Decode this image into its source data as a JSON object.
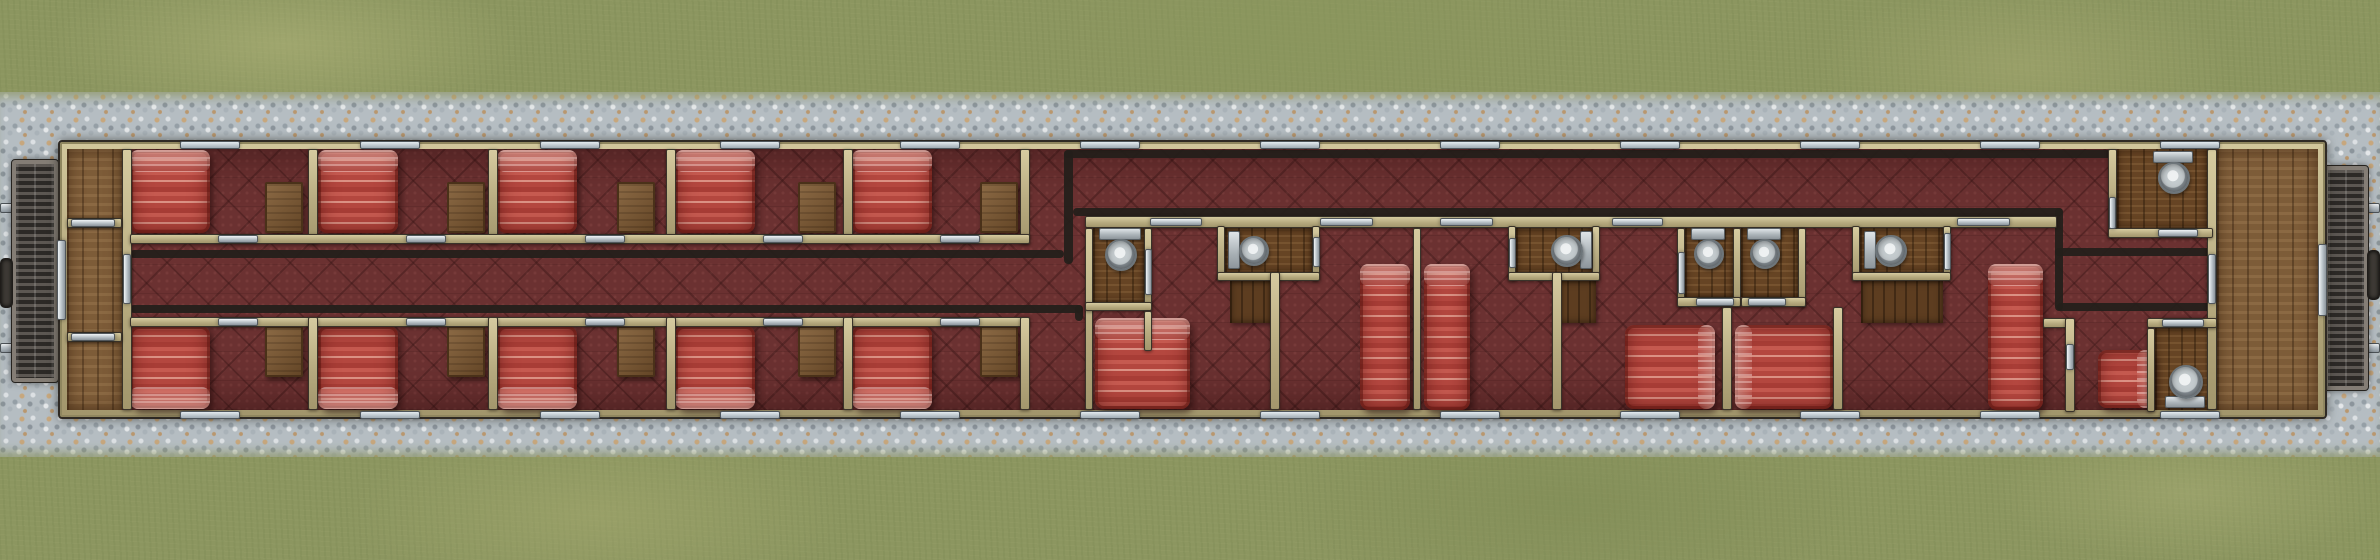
{
  "canvas": {
    "width": 2380,
    "height": 560
  },
  "palette": {
    "grass": "#8c9660",
    "gravel": "#b5bdc2",
    "car_wall_tan": "#b7ab80",
    "carpet_red": "#6b3131",
    "corridor_line": "#241f1b",
    "vestibule_wood": "#85623c",
    "washroom_wood": "#6e4a27",
    "bed_red": "#bb4b42",
    "metal_silver": "#b6bfc5",
    "table_wood": "#7b5731"
  },
  "environment": {
    "gravel_band": [
      0,
      92,
      2380,
      365
    ],
    "rails": [
      [
        0,
        203,
        60,
        10
      ],
      [
        0,
        343,
        60,
        10
      ],
      [
        2320,
        203,
        60,
        10
      ],
      [
        2320,
        343,
        60,
        10
      ]
    ],
    "gangways": [
      [
        12,
        160,
        46,
        222
      ],
      [
        2324,
        166,
        44,
        224
      ]
    ],
    "couplers": [
      [
        0,
        258,
        13,
        50
      ],
      [
        2367,
        250,
        13,
        50
      ]
    ]
  },
  "car": {
    "body": [
      58,
      140,
      2269,
      279
    ],
    "carpet": [
      67,
      149,
      2251,
      261
    ]
  },
  "floors": {
    "vestibules": [
      [
        67,
        149,
        55,
        261
      ],
      [
        2217,
        149,
        101,
        261
      ]
    ],
    "washrooms": [
      [
        1093,
        228,
        51,
        74
      ],
      [
        1225,
        228,
        87,
        44
      ],
      [
        1516,
        228,
        76,
        44
      ],
      [
        1685,
        228,
        48,
        69
      ],
      [
        1741,
        228,
        57,
        69
      ],
      [
        1860,
        228,
        83,
        44
      ],
      [
        2117,
        149,
        90,
        79
      ],
      [
        2155,
        328,
        62,
        82
      ]
    ],
    "wood_steps": [
      [
        1230,
        281,
        42,
        42
      ],
      [
        1556,
        281,
        40,
        42
      ],
      [
        1861,
        281,
        82,
        42
      ]
    ]
  },
  "corridor_lines": [
    [
      130,
      250,
      934,
      8
    ],
    [
      1064,
      150,
      9,
      114
    ],
    [
      1064,
      150,
      1149,
      8
    ],
    [
      1073,
      208,
      990,
      8
    ],
    [
      130,
      305,
      953,
      8
    ],
    [
      1075,
      305,
      8,
      16
    ],
    [
      2055,
      208,
      8,
      103
    ],
    [
      2055,
      248,
      158,
      8
    ],
    [
      2057,
      303,
      156,
      8
    ]
  ],
  "walls": [
    [
      122,
      149,
      10,
      261
    ],
    [
      67,
      218,
      55,
      10
    ],
    [
      67,
      332,
      55,
      10
    ],
    [
      2207,
      149,
      10,
      261
    ],
    [
      308,
      149,
      10,
      95
    ],
    [
      488,
      149,
      10,
      95
    ],
    [
      666,
      149,
      10,
      95
    ],
    [
      843,
      149,
      10,
      95
    ],
    [
      1020,
      149,
      10,
      95
    ],
    [
      130,
      234,
      900,
      10
    ],
    [
      130,
      317,
      900,
      10
    ],
    [
      308,
      317,
      10,
      93
    ],
    [
      488,
      317,
      10,
      93
    ],
    [
      666,
      317,
      10,
      93
    ],
    [
      843,
      317,
      10,
      93
    ],
    [
      1020,
      317,
      10,
      93
    ],
    [
      1085,
      216,
      972,
      12
    ],
    [
      1085,
      228,
      8,
      182
    ],
    [
      1144,
      228,
      8,
      83
    ],
    [
      1085,
      302,
      67,
      9
    ],
    [
      1144,
      311,
      8,
      40
    ],
    [
      1217,
      226,
      8,
      55
    ],
    [
      1312,
      226,
      8,
      55
    ],
    [
      1217,
      272,
      103,
      9
    ],
    [
      1270,
      272,
      10,
      138
    ],
    [
      1413,
      228,
      8,
      182
    ],
    [
      1508,
      226,
      8,
      55
    ],
    [
      1592,
      226,
      8,
      55
    ],
    [
      1508,
      272,
      92,
      9
    ],
    [
      1552,
      272,
      10,
      138
    ],
    [
      1677,
      228,
      8,
      79
    ],
    [
      1733,
      228,
      8,
      79
    ],
    [
      1798,
      228,
      8,
      79
    ],
    [
      1677,
      297,
      64,
      10
    ],
    [
      1741,
      297,
      65,
      10
    ],
    [
      1722,
      307,
      10,
      103
    ],
    [
      1833,
      307,
      10,
      103
    ],
    [
      1852,
      226,
      8,
      55
    ],
    [
      1943,
      226,
      8,
      55
    ],
    [
      1852,
      272,
      99,
      9
    ],
    [
      2043,
      318,
      32,
      10
    ],
    [
      2065,
      318,
      10,
      94
    ],
    [
      2147,
      318,
      70,
      10
    ],
    [
      2147,
      328,
      8,
      84
    ],
    [
      2108,
      149,
      9,
      89
    ],
    [
      2108,
      228,
      105,
      10
    ]
  ],
  "doors": {
    "horizontal": [
      [
        71,
        219,
        44,
        8
      ],
      [
        71,
        333,
        44,
        8
      ],
      [
        218,
        235,
        40,
        8
      ],
      [
        406,
        235,
        40,
        8
      ],
      [
        585,
        235,
        40,
        8
      ],
      [
        763,
        235,
        40,
        8
      ],
      [
        940,
        235,
        40,
        8
      ],
      [
        218,
        318,
        40,
        8
      ],
      [
        406,
        318,
        40,
        8
      ],
      [
        585,
        318,
        40,
        8
      ],
      [
        763,
        318,
        40,
        8
      ],
      [
        940,
        318,
        40,
        8
      ],
      [
        1150,
        218,
        52,
        8
      ],
      [
        1320,
        218,
        53,
        8
      ],
      [
        1440,
        218,
        53,
        8
      ],
      [
        1612,
        218,
        51,
        8
      ],
      [
        1957,
        218,
        53,
        8
      ],
      [
        1696,
        298,
        38,
        8
      ],
      [
        1748,
        298,
        38,
        8
      ],
      [
        2162,
        319,
        42,
        8
      ],
      [
        2158,
        229,
        40,
        8
      ]
    ],
    "vertical": [
      [
        123,
        254,
        8,
        50
      ],
      [
        2208,
        254,
        8,
        50
      ],
      [
        57,
        240,
        9,
        80
      ],
      [
        2318,
        244,
        9,
        72
      ],
      [
        1145,
        249,
        7,
        46
      ],
      [
        1313,
        237,
        7,
        30
      ],
      [
        1509,
        238,
        7,
        30
      ],
      [
        1678,
        252,
        7,
        42
      ],
      [
        1944,
        233,
        7,
        37
      ],
      [
        2066,
        344,
        8,
        26
      ],
      [
        2109,
        197,
        7,
        32
      ]
    ]
  },
  "windows": {
    "xs": [
      180,
      360,
      540,
      720,
      900,
      1080,
      1260,
      1440,
      1620,
      1800,
      1980,
      2160
    ],
    "top_y": 141,
    "bottom_y": 411,
    "w": 60,
    "h": 8
  },
  "furniture": {
    "beds": [
      {
        "r": [
          130,
          150,
          80,
          83
        ],
        "pillow": "top"
      },
      {
        "r": [
          318,
          150,
          80,
          83
        ],
        "pillow": "top"
      },
      {
        "r": [
          497,
          150,
          80,
          83
        ],
        "pillow": "top"
      },
      {
        "r": [
          675,
          150,
          80,
          83
        ],
        "pillow": "top"
      },
      {
        "r": [
          852,
          150,
          80,
          83
        ],
        "pillow": "top"
      },
      {
        "r": [
          130,
          326,
          80,
          83
        ],
        "pillow": "bottom"
      },
      {
        "r": [
          318,
          326,
          80,
          83
        ],
        "pillow": "bottom"
      },
      {
        "r": [
          497,
          326,
          80,
          83
        ],
        "pillow": "bottom"
      },
      {
        "r": [
          675,
          326,
          80,
          83
        ],
        "pillow": "bottom"
      },
      {
        "r": [
          852,
          326,
          80,
          83
        ],
        "pillow": "bottom"
      },
      {
        "r": [
          1095,
          318,
          95,
          91
        ],
        "pillow": "top"
      },
      {
        "r": [
          1360,
          264,
          50,
          146
        ],
        "pillow": "top"
      },
      {
        "r": [
          1424,
          264,
          46,
          146
        ],
        "pillow": "top"
      },
      {
        "r": [
          1625,
          325,
          90,
          84
        ],
        "pillow": "right"
      },
      {
        "r": [
          1735,
          325,
          98,
          84
        ],
        "pillow": "left"
      },
      {
        "r": [
          1988,
          264,
          55,
          146
        ],
        "pillow": "top"
      },
      {
        "r": [
          2098,
          350,
          56,
          58
        ],
        "pillow": "right"
      }
    ],
    "tables": [
      [
        265,
        182,
        38,
        51
      ],
      [
        447,
        182,
        38,
        51
      ],
      [
        617,
        182,
        38,
        51
      ],
      [
        798,
        182,
        38,
        51
      ],
      [
        980,
        182,
        38,
        51
      ],
      [
        265,
        326,
        38,
        51
      ],
      [
        447,
        326,
        38,
        51
      ],
      [
        617,
        326,
        38,
        51
      ],
      [
        798,
        326,
        38,
        51
      ],
      [
        980,
        326,
        38,
        51
      ]
    ],
    "toilets": [
      {
        "r": [
          1098,
          228,
          42,
          42
        ],
        "dir": "down"
      },
      {
        "r": [
          1228,
          230,
          40,
          38
        ],
        "dir": "right"
      },
      {
        "r": [
          1548,
          230,
          42,
          38
        ],
        "dir": "left"
      },
      {
        "r": [
          1690,
          228,
          34,
          40
        ],
        "dir": "down"
      },
      {
        "r": [
          1746,
          228,
          34,
          40
        ],
        "dir": "down"
      },
      {
        "r": [
          1864,
          230,
          42,
          38
        ],
        "dir": "right"
      },
      {
        "r": [
          2152,
          151,
          40,
          42
        ],
        "dir": "down"
      },
      {
        "r": [
          2164,
          362,
          40,
          44
        ],
        "dir": "up"
      }
    ]
  }
}
